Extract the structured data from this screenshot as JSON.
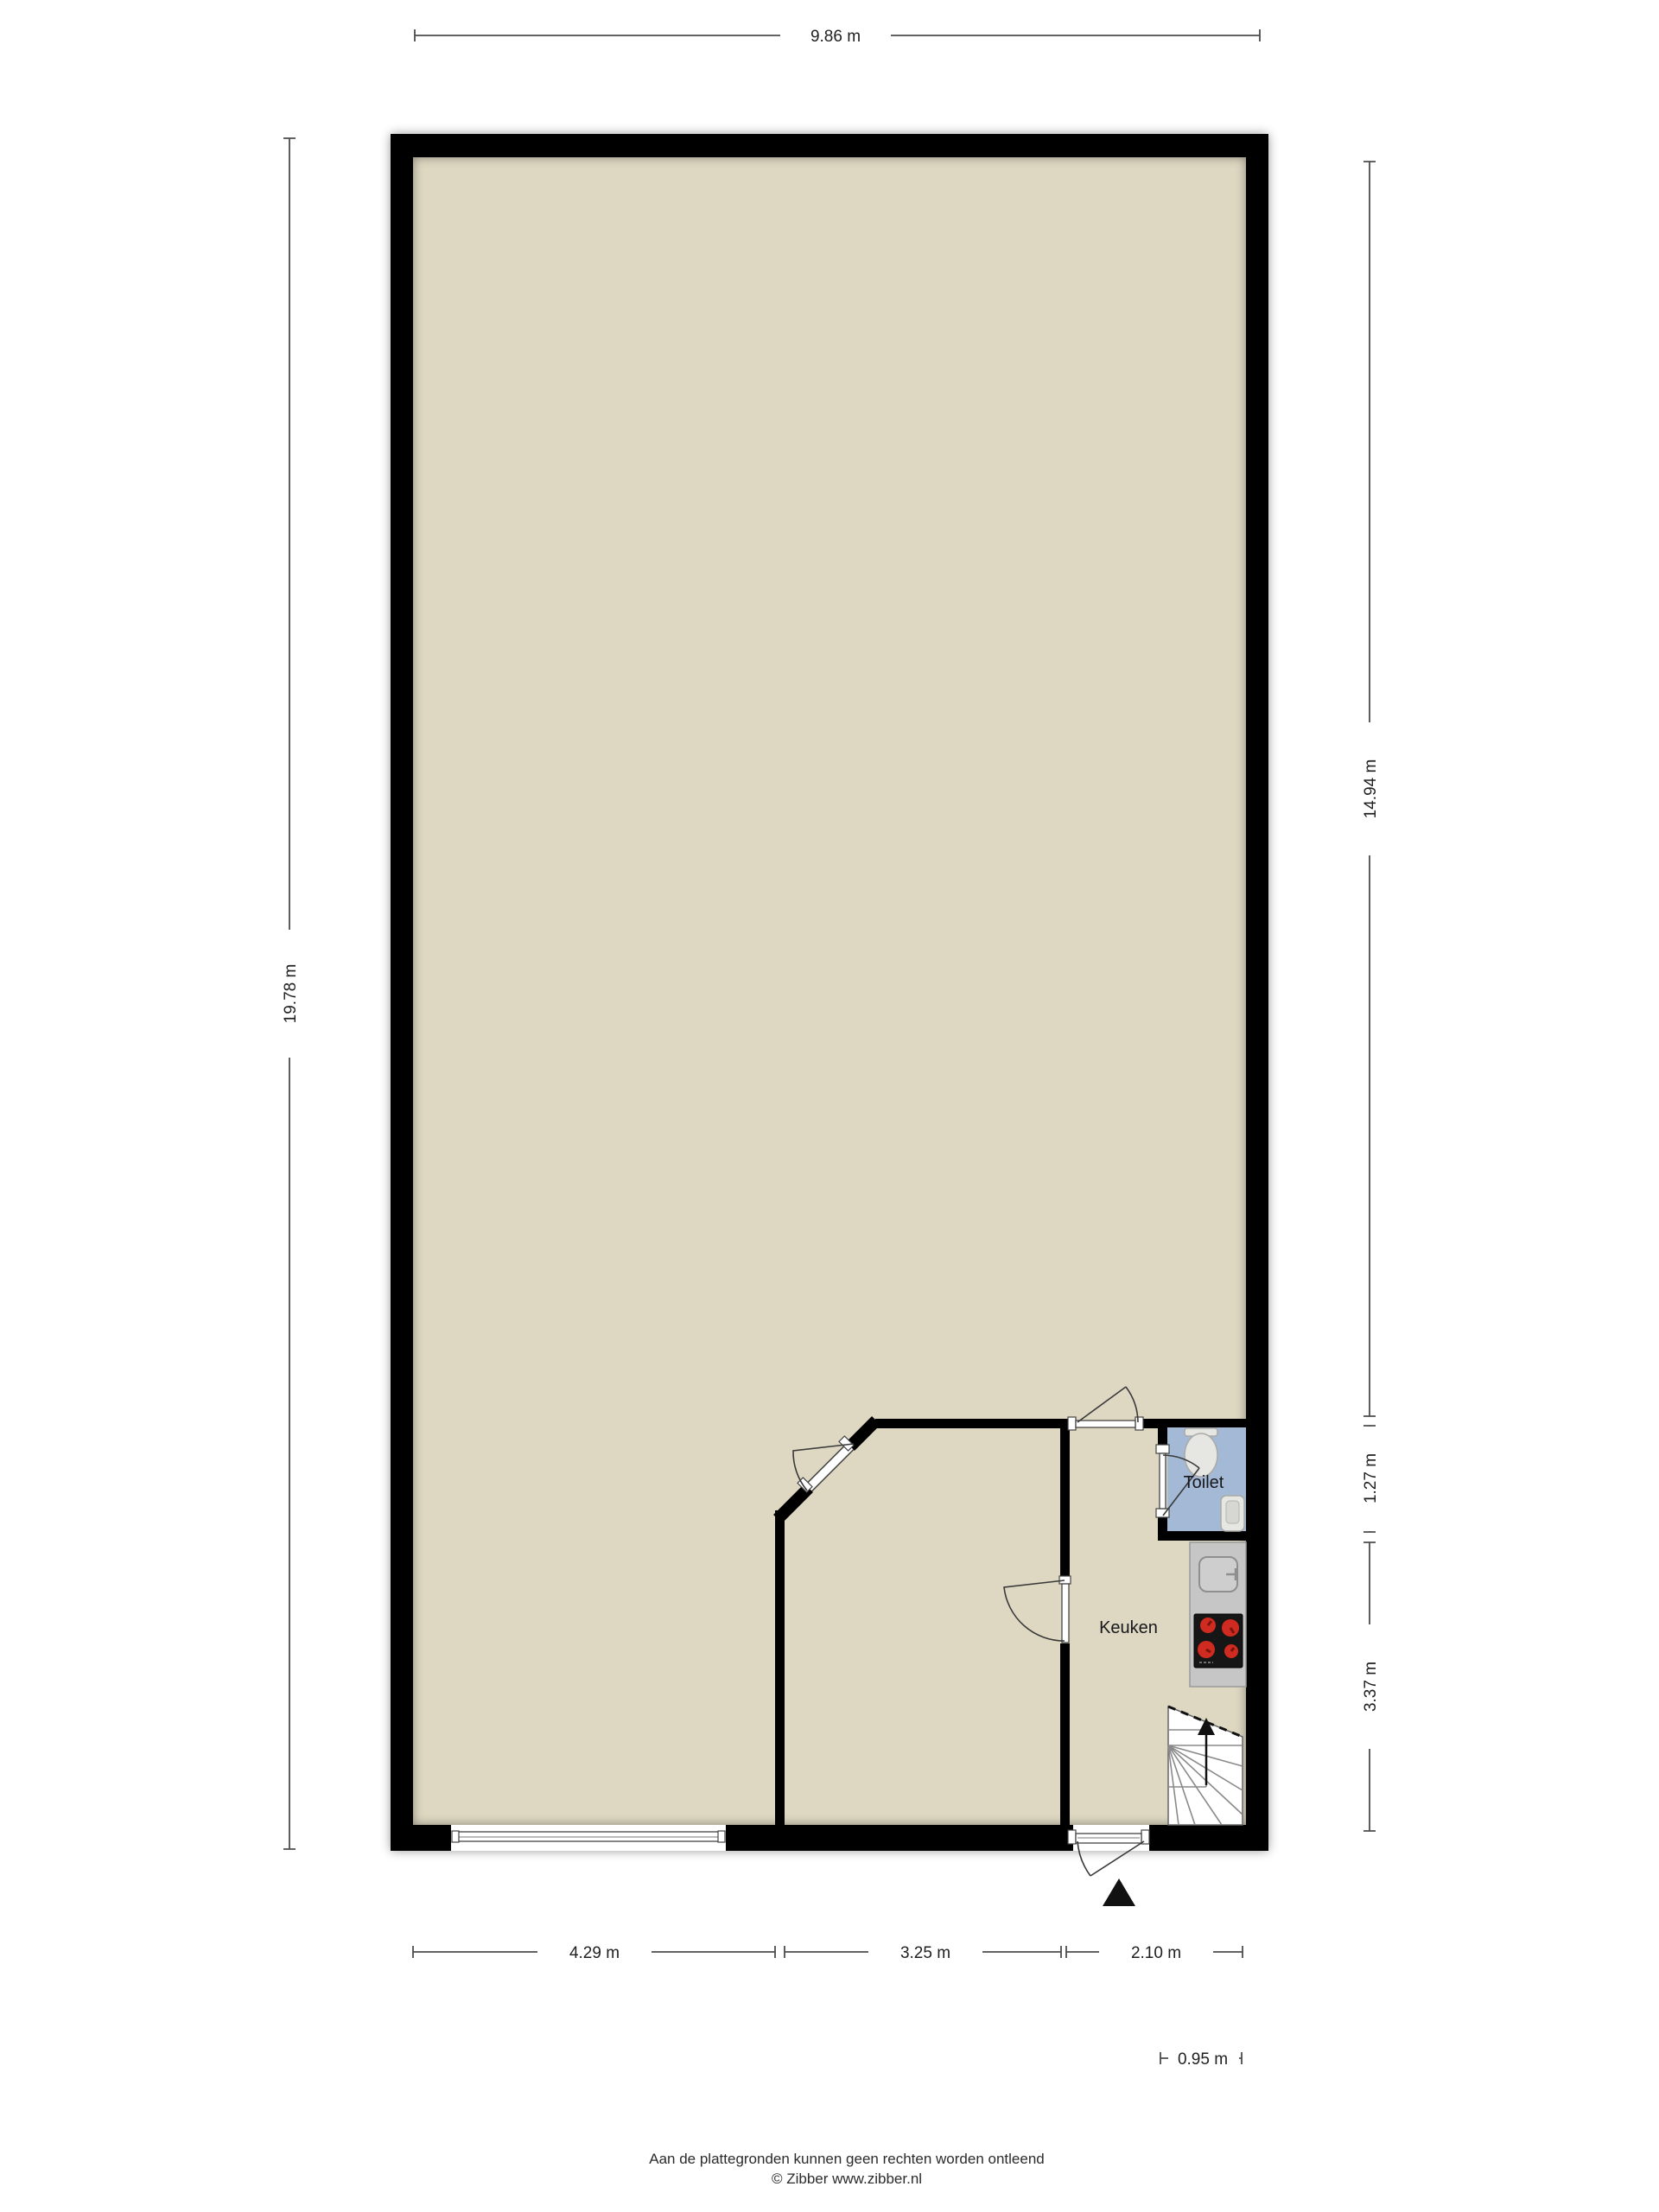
{
  "plan": {
    "type": "floorplan",
    "rooms": [
      {
        "name": "Toilet"
      },
      {
        "name": "Keuken"
      }
    ],
    "fixtures": [
      "toilet",
      "hand-basin",
      "kitchen-sink",
      "cooktop",
      "stairs",
      "entrance-arrow",
      "window",
      "doors"
    ]
  },
  "dimensions": {
    "top": {
      "label": "9.86 m"
    },
    "left": {
      "label": "19.78 m"
    },
    "right": [
      {
        "label": "14.94 m"
      },
      {
        "label": "1.27 m"
      },
      {
        "label": "3.37 m"
      }
    ],
    "bottom": [
      {
        "label": "4.29 m"
      },
      {
        "label": "3.25 m"
      },
      {
        "label": "2.10 m"
      }
    ],
    "detail": {
      "label": "0.95 m"
    }
  },
  "footer": {
    "line1": "Aan de plattegronden kunnen geen rechten worden ontleend",
    "line2": "© Zibber www.zibber.nl"
  },
  "colors": {
    "wall": "#000000",
    "floor": "#ded8c2",
    "toiletFloor": "#a3b9d6",
    "counter": "#c6c6c6",
    "stove": "#161616",
    "burner": "#cf2b20",
    "dim": "#4d4d4d",
    "ink": "#1f1f1f"
  }
}
